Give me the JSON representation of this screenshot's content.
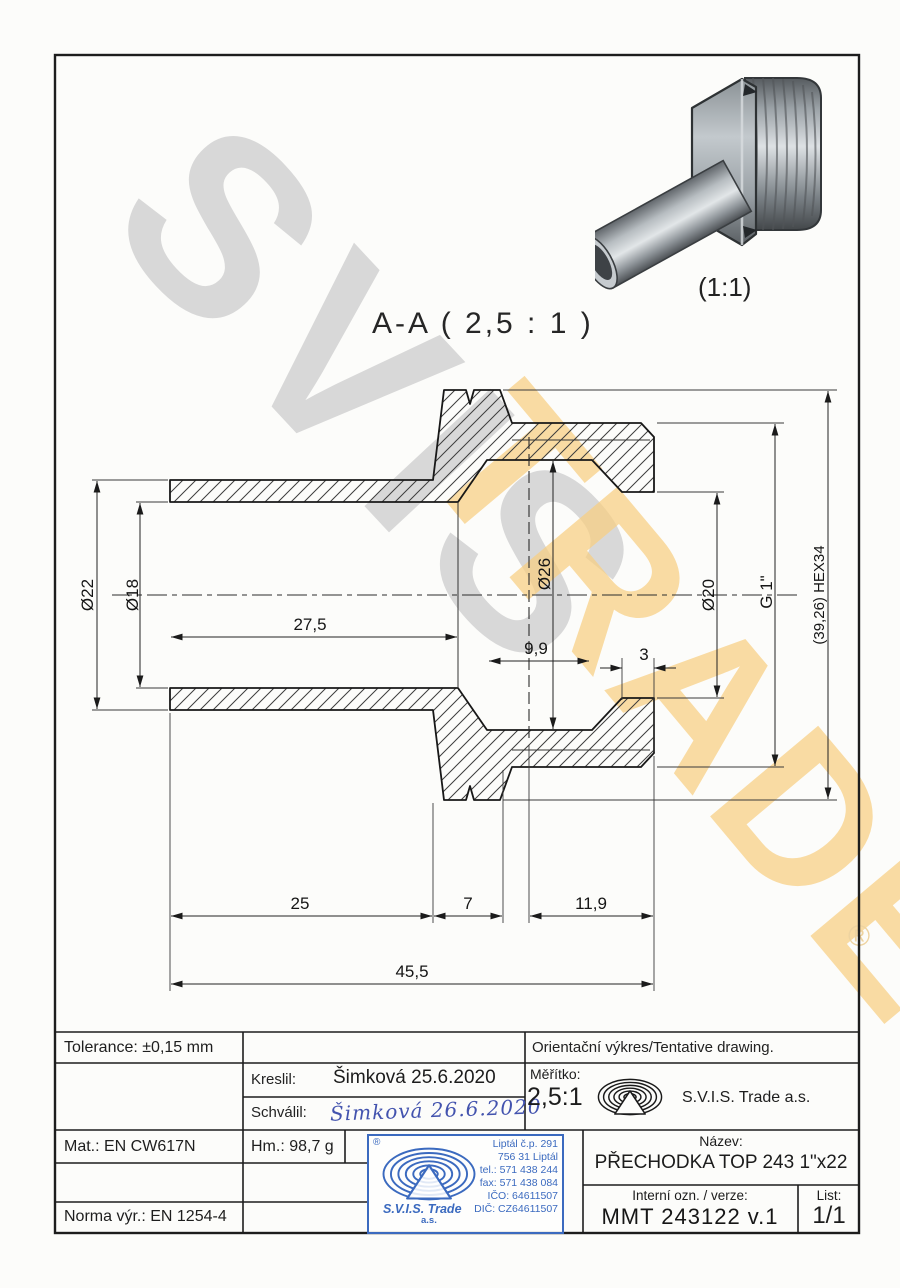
{
  "watermark": {
    "line1": "SVIS",
    "line2": "TRADE",
    "registered": "®",
    "gray": "#d7d7d7",
    "orange": "#f8cf82"
  },
  "section_label": "A-A ( 2,5 : 1 )",
  "render_scale_label": "(1:1)",
  "dimensions": {
    "d22": "Ø22",
    "d18": "Ø18",
    "l27_5": "27,5",
    "d26": "Ø26",
    "l9_9": "9,9",
    "l3": "3",
    "d20": "Ø20",
    "g1": "G 1\"",
    "hex": "(39,26) HEX34",
    "l25": "25",
    "l7": "7",
    "l11_9": "11,9",
    "l45_5": "45,5"
  },
  "title_block": {
    "tolerance": "Tolerance: ±0,15 mm",
    "kreslil_label": "Kreslil:",
    "kreslil_value": "Šimková 25.6.2020",
    "schvalil_label": "Schválil:",
    "schvalil_signature": "Šimková 26.6.2020",
    "mat": "Mat.: EN CW617N",
    "hm": "Hm.: 98,7 g",
    "norma": "Norma výr.: EN 1254-4",
    "orientacni": "Orientační výkres/Tentative drawing.",
    "meritko_label": "Měřítko:",
    "meritko_value": "2,5:1",
    "company": "S.V.I.S. Trade a.s.",
    "nazev_label": "Název:",
    "nazev_value": "PŘECHODKA TOP 243 1\"x22",
    "interni_label": "Interní ozn. / verze:",
    "interni_value": "MMT 243122 v.1",
    "list_label": "List:",
    "list_value": "1/1"
  },
  "stamp": {
    "registered": "®",
    "company_line1": "S.V.I.S. Trade",
    "company_line2": "a.s.",
    "address": [
      "Liptál č.p. 291",
      "756 31 Liptál",
      "tel.: 571 438 244",
      "fax: 571 438 084",
      "IČO: 64611507",
      "DIČ: CZ64611507"
    ],
    "blue": "#3b6abf"
  }
}
